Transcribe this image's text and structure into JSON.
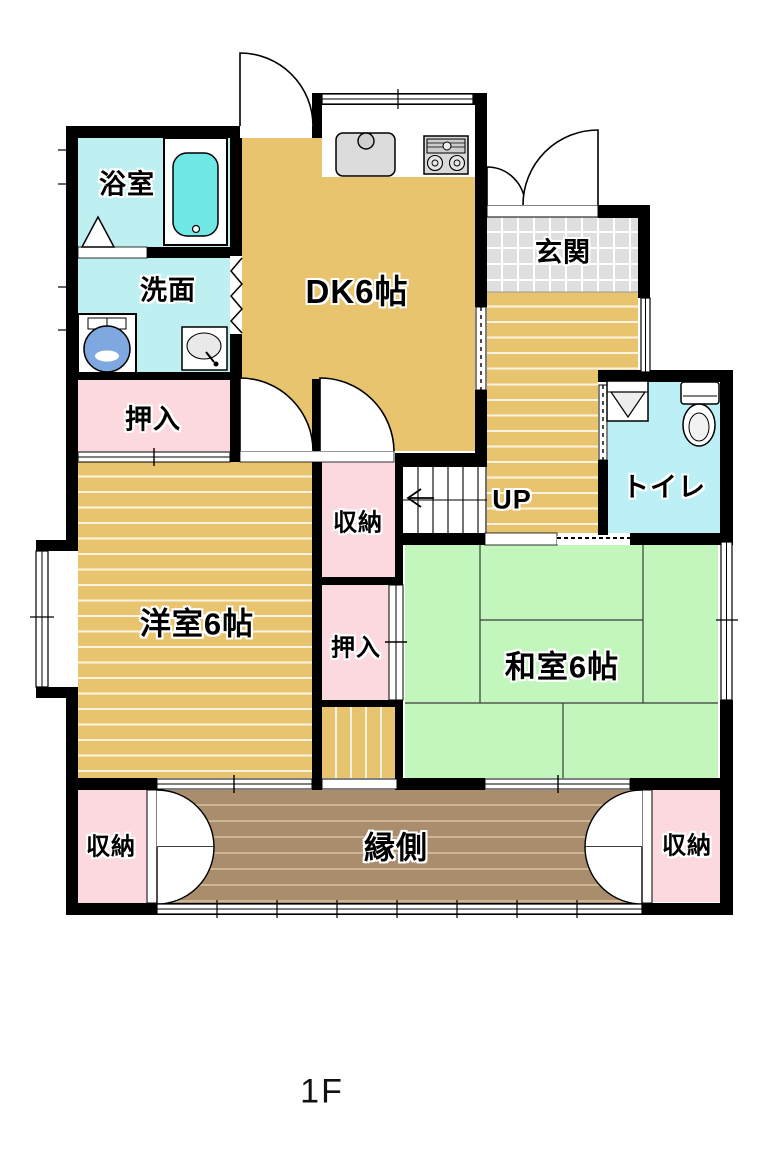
{
  "floor_label": "1F",
  "rooms": {
    "bathroom": {
      "label": "浴室"
    },
    "washroom": {
      "label": "洗面"
    },
    "dining_kitchen": {
      "label": "DK6帖"
    },
    "entrance": {
      "label": "玄関"
    },
    "toilet": {
      "label": "トイレ"
    },
    "stairs": {
      "label": "UP"
    },
    "closet_north": {
      "label": "押入"
    },
    "storage_center": {
      "label": "収納"
    },
    "closet_center": {
      "label": "押入"
    },
    "western_room": {
      "label": "洋室6帖"
    },
    "japanese_room": {
      "label": "和室6帖"
    },
    "veranda": {
      "label": "縁側"
    },
    "storage_southwest": {
      "label": "収納"
    },
    "storage_southeast": {
      "label": "収納"
    }
  },
  "colors": {
    "wall": "#000000",
    "wood": "#E9C46F",
    "tatami": "#C3F6BD",
    "closet": "#FBD9DE",
    "bath": "#BFF0F1",
    "toilet_c": "#BDF0F6",
    "tile": "#DFDFDF",
    "veranda": "#A98D6D",
    "veranda_stripe": "#CDB695",
    "tub": "#6FE8E6",
    "washer": "#7FA8E0",
    "fixture": "#DCDCDC"
  }
}
